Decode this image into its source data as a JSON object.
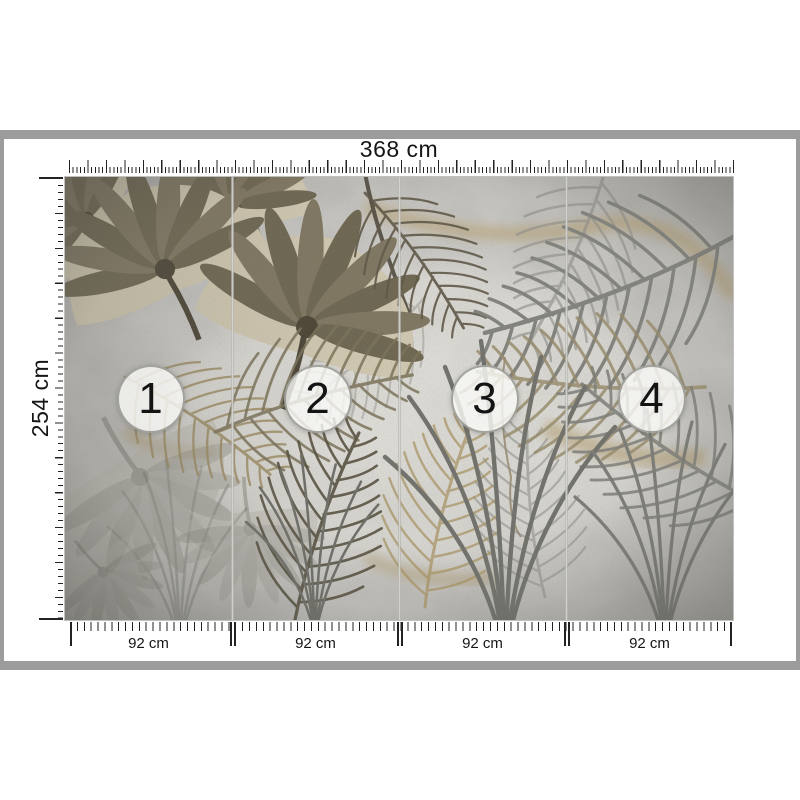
{
  "preview": {
    "width_label": "368 cm",
    "height_label": "254 cm",
    "panels": [
      {
        "number": "1",
        "width_label": "92 cm"
      },
      {
        "number": "2",
        "width_label": "92 cm"
      },
      {
        "number": "3",
        "width_label": "92 cm"
      },
      {
        "number": "4",
        "width_label": "92 cm"
      }
    ],
    "colors": {
      "frame": "#9c9c9c",
      "tick": "#222222",
      "badge_ring": "#8e8e89",
      "concrete_light": "#deddd9",
      "concrete_dark": "#a9a8a4",
      "leaf_olive": "#6d654f",
      "leaf_cream": "#d3cab2",
      "gold_vein": "#b2965e",
      "frond_grey": "#83837e"
    }
  }
}
